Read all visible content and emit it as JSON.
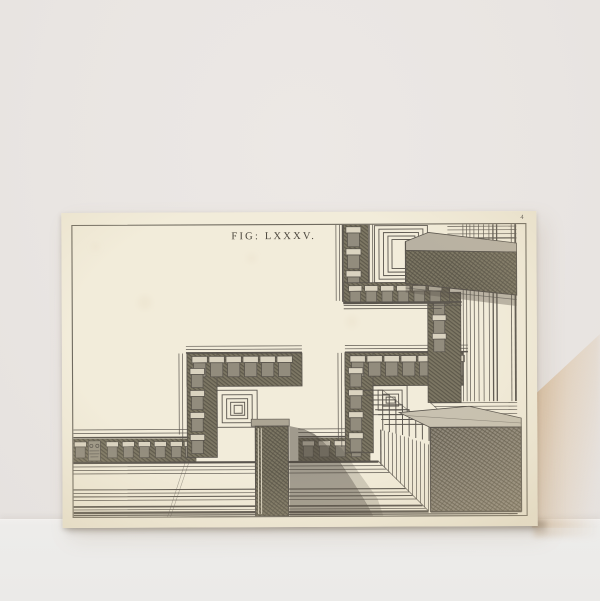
{
  "scene": {
    "description": "Antique engraved perspective plate leaning against a pale wall with a warm cast shadow",
    "wall_color": "#e9e5e2",
    "floor_color": "#ebeae8",
    "cast_shadow_color": "#d8b994"
  },
  "print": {
    "caption": "FIG: LXXXV.",
    "plate_number": "4",
    "paper_color": "#f2ecda",
    "ink_color": "#57524a",
    "subject": "Perspective study of stepped classical cornice moldings with dentil blocks"
  }
}
